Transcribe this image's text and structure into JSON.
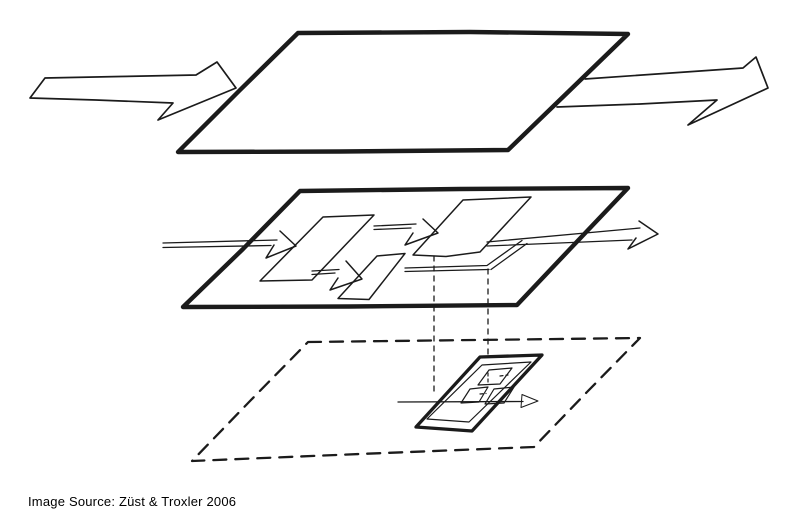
{
  "canvas": {
    "background": "#ffffff",
    "ink": "#1b1b1b",
    "text_color": "#000000"
  },
  "caption": {
    "text": "Image Source: Züst & Troxler 2006"
  },
  "figure": {
    "kind": "hand-drawn-exploded-view-sketch",
    "layers": [
      "top-plane",
      "middle-plane",
      "bottom-plane"
    ]
  }
}
